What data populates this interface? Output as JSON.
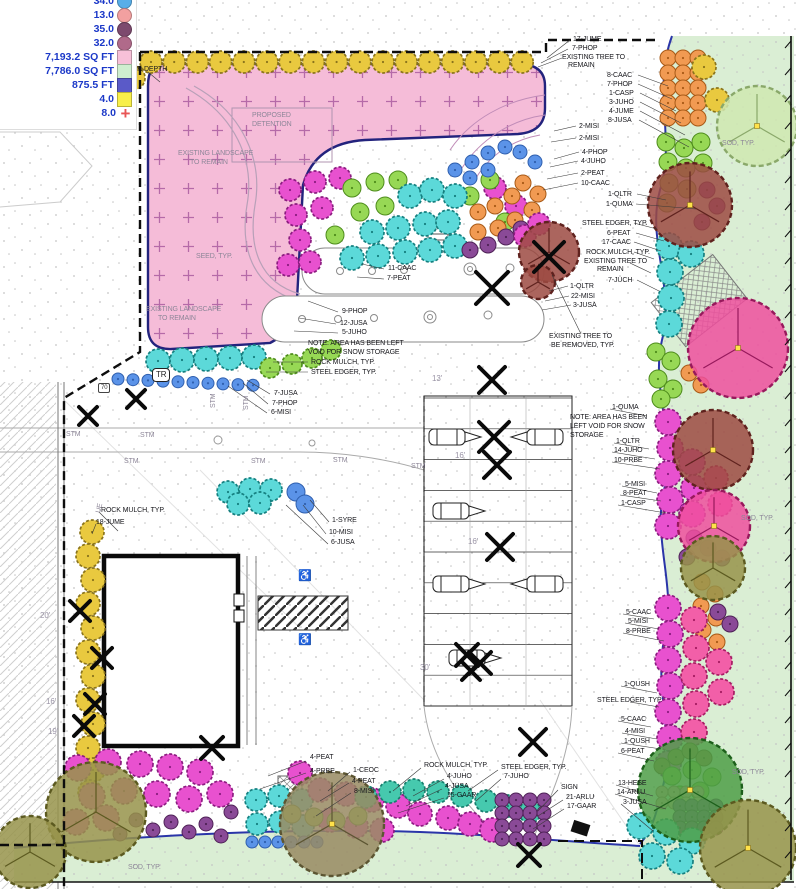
{
  "legend": {
    "text_color": "#1b38c8",
    "items": [
      {
        "label": "34.0",
        "shape": "circle",
        "color": "#58aee8",
        "icon": "plant-symbol-swatch",
        "cut": true
      },
      {
        "label": "13.0",
        "shape": "circle",
        "color": "#f2a0a0",
        "icon": "plant-symbol-swatch"
      },
      {
        "label": "35.0",
        "shape": "circle",
        "color": "#7d4a6e",
        "icon": "plant-symbol-swatch"
      },
      {
        "label": "32.0",
        "shape": "circle",
        "color": "#b06a8a",
        "icon": "plant-symbol-swatch"
      },
      {
        "label": "7,193.2 SQ FT",
        "shape": "square",
        "color": "#f7c0d8",
        "icon": "area-swatch"
      },
      {
        "label": "7,786.0 SQ FT",
        "shape": "square",
        "color": "#cfeecf",
        "icon": "area-swatch"
      },
      {
        "label": "875.5 FT",
        "shape": "square",
        "color": "#5a5ac8",
        "icon": "length-swatch"
      },
      {
        "label": "4.0",
        "shape": "square",
        "color": "#f8ef4a",
        "icon": "area-swatch"
      },
      {
        "label": "8.0",
        "shape": "plus",
        "color": "#e85555",
        "icon": "plus-marker-icon"
      }
    ]
  },
  "plan": {
    "palette": {
      "pink_fill": "#f5bcd8",
      "pink_edge": "#23237d",
      "plus_mark": "#b56aa8",
      "sod_fill": "#daeed4",
      "bed_edge": "#2a35a8",
      "boundary": "#0d0d0d",
      "stipple": "#c4c4c4",
      "plants": {
        "cyan": [
          "#5cd9d9",
          "#157f7f"
        ],
        "green": [
          "#97d855",
          "#4e8c1c"
        ],
        "magenta": [
          "#e851cf",
          "#8c1c80"
        ],
        "orange": [
          "#f19a52",
          "#a85a17"
        ],
        "blue": [
          "#5b93e8",
          "#2f5fae"
        ],
        "yellow": [
          "#e9c93f",
          "#8a741c"
        ],
        "purple": [
          "#8a4a97",
          "#4f2257"
        ],
        "salmon": [
          "#efa5a5",
          "#b06464"
        ],
        "teal": [
          "#46c9ae",
          "#177f6e"
        ],
        "hotpink": [
          "#f25fa8",
          "#a61c62"
        ],
        "brown": [
          "#b07a52",
          "#6e4422"
        ]
      },
      "canopies": {
        "maroon": [
          "#9c4a42",
          "#5f221e"
        ],
        "pink": [
          "#ef4f9e",
          "#97195c"
        ],
        "olive": [
          "#97934a",
          "#5c5a20"
        ],
        "darkgreen": [
          "#4e9e46",
          "#1c5f1a"
        ],
        "taupe": [
          "#988a62",
          "#5c5532"
        ],
        "palegreen": [
          "#cfe8b0",
          "#8aa86a"
        ]
      }
    },
    "labels": [
      {
        "t": "100-YR DEPTH",
        "x": 119,
        "y": 66
      },
      {
        "t": "PROPOSED",
        "x": 252,
        "y": 112,
        "cls": "gray"
      },
      {
        "t": "DETENTION",
        "x": 252,
        "y": 121,
        "cls": "gray"
      },
      {
        "t": "EXISTING LANDSCAPE",
        "x": 178,
        "y": 150,
        "cls": "gray"
      },
      {
        "t": "TO REMAIN",
        "x": 190,
        "y": 159,
        "cls": "gray"
      },
      {
        "t": "SEED, TYP.",
        "x": 196,
        "y": 253,
        "cls": "gray"
      },
      {
        "t": "EXISTING LANDSCAPE",
        "x": 146,
        "y": 306,
        "cls": "gray"
      },
      {
        "t": "TO REMAIN",
        "x": 158,
        "y": 315,
        "cls": "gray"
      },
      {
        "t": "17-JUME",
        "x": 573,
        "y": 36
      },
      {
        "t": "7-PHOP",
        "x": 572,
        "y": 45
      },
      {
        "t": "EXISTING TREE TO",
        "x": 562,
        "y": 54
      },
      {
        "t": "REMAIN",
        "x": 568,
        "y": 62
      },
      {
        "t": "8-CAAC",
        "x": 607,
        "y": 72
      },
      {
        "t": "7-PHOP",
        "x": 607,
        "y": 81
      },
      {
        "t": "1-CASP",
        "x": 609,
        "y": 90
      },
      {
        "t": "3-JUHO",
        "x": 609,
        "y": 99
      },
      {
        "t": "4-JUME",
        "x": 609,
        "y": 108
      },
      {
        "t": "8-JUSA",
        "x": 608,
        "y": 117
      },
      {
        "t": "2-MISI",
        "x": 579,
        "y": 123
      },
      {
        "t": "2-MISI",
        "x": 579,
        "y": 135
      },
      {
        "t": "4-PHOP",
        "x": 582,
        "y": 149
      },
      {
        "t": "4-JUHO",
        "x": 581,
        "y": 158
      },
      {
        "t": "2-PEAT",
        "x": 581,
        "y": 170
      },
      {
        "t": "10-CAAC",
        "x": 581,
        "y": 180
      },
      {
        "t": "1-QLTR",
        "x": 608,
        "y": 191
      },
      {
        "t": "1-QUMA",
        "x": 606,
        "y": 201
      },
      {
        "t": "STEEL EDGER, TYP.",
        "x": 582,
        "y": 220
      },
      {
        "t": "6-PEAT",
        "x": 607,
        "y": 230
      },
      {
        "t": "17-CAAC",
        "x": 602,
        "y": 239
      },
      {
        "t": "ROCK MULCH, TYP.",
        "x": 586,
        "y": 249
      },
      {
        "t": "EXISTING TREE TO",
        "x": 584,
        "y": 258
      },
      {
        "t": "REMAIN",
        "x": 597,
        "y": 266
      },
      {
        "t": "7-JUCH",
        "x": 608,
        "y": 277
      },
      {
        "t": "1-QLTR",
        "x": 570,
        "y": 283
      },
      {
        "t": "22-MISI",
        "x": 571,
        "y": 293
      },
      {
        "t": "3-JUSA",
        "x": 573,
        "y": 302
      },
      {
        "t": "EXISTING TREE TO",
        "x": 549,
        "y": 333
      },
      {
        "t": "BE REMOVED, TYP.",
        "x": 551,
        "y": 342
      },
      {
        "t": "11-CAAC",
        "x": 388,
        "y": 265
      },
      {
        "t": "7-PEAT",
        "x": 387,
        "y": 275
      },
      {
        "t": "9-PHOP",
        "x": 342,
        "y": 308
      },
      {
        "t": "12-JUSA",
        "x": 340,
        "y": 320
      },
      {
        "t": "5-JUHO",
        "x": 342,
        "y": 329
      },
      {
        "t": "NOTE:  AREA HAS BEEN LEFT",
        "x": 308,
        "y": 340
      },
      {
        "t": "VOID FOR SNOW STORAGE",
        "x": 308,
        "y": 349
      },
      {
        "t": "ROCK MULCH, TYP.",
        "x": 311,
        "y": 359
      },
      {
        "t": "STEEL EDGER, TYP.",
        "x": 311,
        "y": 369
      },
      {
        "t": "7-JUSA",
        "x": 274,
        "y": 390
      },
      {
        "t": "7-PHOP",
        "x": 272,
        "y": 400
      },
      {
        "t": "6-MISI",
        "x": 271,
        "y": 409
      },
      {
        "t": "TR",
        "x": 152,
        "y": 368,
        "cls": "boxed",
        "n": "transformer-box-label"
      },
      {
        "t": "70",
        "x": 98,
        "y": 383,
        "cls": "sbox",
        "n": "utility-tag-label"
      },
      {
        "t": "STM",
        "x": 66,
        "y": 431,
        "cls": "gray",
        "n": "storm-line-label"
      },
      {
        "t": "STM",
        "x": 140,
        "y": 432,
        "cls": "gray",
        "n": "storm-line-label"
      },
      {
        "t": "STM",
        "x": 124,
        "y": 458,
        "cls": "gray",
        "n": "storm-line-label"
      },
      {
        "t": "STM",
        "x": 251,
        "y": 458,
        "cls": "gray",
        "n": "storm-line-label"
      },
      {
        "t": "STM",
        "x": 333,
        "y": 457,
        "cls": "gray",
        "n": "storm-line-label"
      },
      {
        "t": "STM",
        "x": 411,
        "y": 463,
        "cls": "gray",
        "n": "storm-line-label"
      },
      {
        "t": "STM",
        "x": 210,
        "y": 408,
        "cls": "gray",
        "rot": -90,
        "n": "storm-line-label"
      },
      {
        "t": "STM",
        "x": 243,
        "y": 410,
        "cls": "gray",
        "rot": -90,
        "n": "storm-line-label"
      },
      {
        "t": "UE",
        "x": 95,
        "y": 512,
        "cls": "gray",
        "rot": -75,
        "n": "utility-line-label"
      },
      {
        "t": "1-QUMA",
        "x": 612,
        "y": 404
      },
      {
        "t": "NOTE:  AREA HAS BEEN",
        "x": 570,
        "y": 414
      },
      {
        "t": "LEFT VOID FOR SNOW",
        "x": 570,
        "y": 423
      },
      {
        "t": "STORAGE",
        "x": 570,
        "y": 432
      },
      {
        "t": "1-QLTR",
        "x": 616,
        "y": 438
      },
      {
        "t": "14-JUHO",
        "x": 614,
        "y": 447
      },
      {
        "t": "10-PRBE",
        "x": 614,
        "y": 457
      },
      {
        "t": "5-MISI",
        "x": 625,
        "y": 481
      },
      {
        "t": "8-PEAT",
        "x": 623,
        "y": 490
      },
      {
        "t": "1-CASP",
        "x": 621,
        "y": 500
      },
      {
        "t": "5-CAAC",
        "x": 626,
        "y": 609
      },
      {
        "t": "5-MISI",
        "x": 628,
        "y": 618
      },
      {
        "t": "8-PRBE",
        "x": 626,
        "y": 628
      },
      {
        "t": "1-QUSH",
        "x": 624,
        "y": 681
      },
      {
        "t": "STEEL EDGER, TYP.",
        "x": 597,
        "y": 697
      },
      {
        "t": "5-CAAC",
        "x": 621,
        "y": 716
      },
      {
        "t": "4-MISI",
        "x": 625,
        "y": 728
      },
      {
        "t": "1-QUSH",
        "x": 624,
        "y": 738
      },
      {
        "t": "6-PEAT",
        "x": 621,
        "y": 748
      },
      {
        "t": "13-HESE",
        "x": 618,
        "y": 780
      },
      {
        "t": "14-ARLU",
        "x": 617,
        "y": 789
      },
      {
        "t": "3-JUSA",
        "x": 623,
        "y": 799
      },
      {
        "t": "ROCK MULCH, TYP.",
        "x": 101,
        "y": 507
      },
      {
        "t": "18-JUME",
        "x": 96,
        "y": 519
      },
      {
        "t": "1-SYRE",
        "x": 332,
        "y": 517
      },
      {
        "t": "10-MISI",
        "x": 329,
        "y": 529
      },
      {
        "t": "6-JUSA",
        "x": 331,
        "y": 539
      },
      {
        "t": "4-PEAT",
        "x": 310,
        "y": 754
      },
      {
        "t": "4-PRBE",
        "x": 310,
        "y": 768
      },
      {
        "t": "1-CEOC",
        "x": 353,
        "y": 767
      },
      {
        "t": "4-PEAT",
        "x": 352,
        "y": 778
      },
      {
        "t": "8-MISI",
        "x": 354,
        "y": 788
      },
      {
        "t": "ROCK MULCH, TYP.",
        "x": 424,
        "y": 762
      },
      {
        "t": "4-JUHO",
        "x": 447,
        "y": 773
      },
      {
        "t": "4-JUSA",
        "x": 445,
        "y": 783
      },
      {
        "t": "15-GAAR",
        "x": 447,
        "y": 792
      },
      {
        "t": "STEEL EDGER, TYP.",
        "x": 501,
        "y": 764
      },
      {
        "t": "7-JUHO",
        "x": 504,
        "y": 773
      },
      {
        "t": "SIGN",
        "x": 561,
        "y": 784
      },
      {
        "t": "21-ARLU",
        "x": 566,
        "y": 794
      },
      {
        "t": "17-GAAR",
        "x": 567,
        "y": 803
      },
      {
        "t": "SOD, TYP.",
        "x": 722,
        "y": 140,
        "cls": "gray",
        "n": "surface-label"
      },
      {
        "t": "SOD, TYP.",
        "x": 741,
        "y": 515,
        "cls": "gray",
        "n": "surface-label"
      },
      {
        "t": "SOD, TYP.",
        "x": 732,
        "y": 769,
        "cls": "gray",
        "n": "surface-label"
      },
      {
        "t": "SOD, TYP.",
        "x": 128,
        "y": 864,
        "cls": "gray",
        "n": "surface-label"
      },
      {
        "t": "13'",
        "x": 432,
        "y": 375,
        "cls": "dim",
        "n": "dimension-label"
      },
      {
        "t": "16'",
        "x": 455,
        "y": 452,
        "cls": "dim",
        "n": "dimension-label"
      },
      {
        "t": "16'",
        "x": 468,
        "y": 538,
        "cls": "dim",
        "n": "dimension-label"
      },
      {
        "t": "30'",
        "x": 420,
        "y": 664,
        "cls": "dim",
        "n": "dimension-label"
      },
      {
        "t": "20'",
        "x": 40,
        "y": 612,
        "cls": "dim",
        "n": "dimension-label"
      },
      {
        "t": "16'",
        "x": 46,
        "y": 698,
        "cls": "dim",
        "n": "dimension-label"
      },
      {
        "t": "19'",
        "x": 48,
        "y": 728,
        "cls": "dim",
        "n": "dimension-label"
      },
      {
        "t": "♿",
        "x": 298,
        "y": 571,
        "cls": "icon",
        "n": "accessible-parking-icon"
      },
      {
        "t": "♿",
        "x": 298,
        "y": 635,
        "cls": "icon",
        "n": "accessible-parking-icon"
      }
    ]
  }
}
